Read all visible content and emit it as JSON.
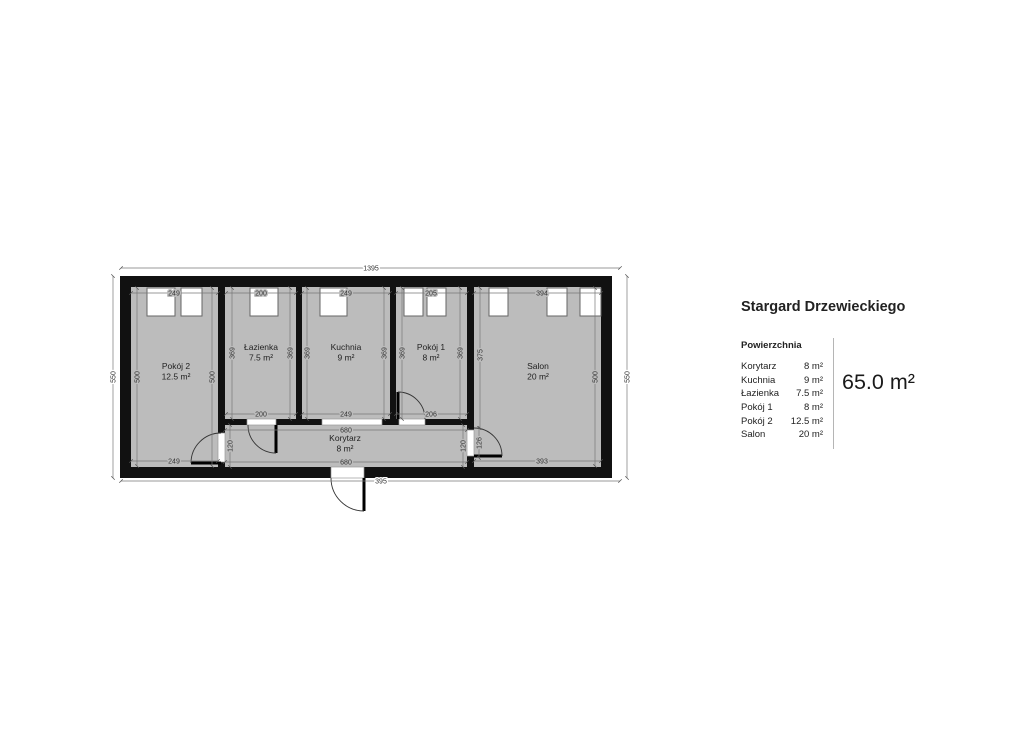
{
  "title": "Stargard Drzewieckiego",
  "panel": {
    "section_label": "Powierzchnia",
    "rows": [
      {
        "name": "Korytarz",
        "area": "8 m²"
      },
      {
        "name": "Kuchnia",
        "area": "9 m²"
      },
      {
        "name": "Łazienka",
        "area": "7.5 m²"
      },
      {
        "name": "Pokój 1",
        "area": "8 m²"
      },
      {
        "name": "Pokój 2",
        "area": "12.5 m²"
      },
      {
        "name": "Salon",
        "area": "20 m²"
      }
    ],
    "total_area": "65.0 m²"
  },
  "plan": {
    "rooms": {
      "pokoj2": {
        "name": "Pokój 2",
        "area": "12.5 m²"
      },
      "lazienka": {
        "name": "Łazienka",
        "area": "7.5 m²"
      },
      "kuchnia": {
        "name": "Kuchnia",
        "area": "9 m²"
      },
      "pokoj1": {
        "name": "Pokój 1",
        "area": "8 m²"
      },
      "salon": {
        "name": "Salon",
        "area": "20 m²"
      },
      "korytarz": {
        "name": "Korytarz",
        "area": "8 m²"
      }
    },
    "dims": {
      "total_width_top": "1395",
      "total_width_bottom": "395",
      "outer_height_left": "550",
      "outer_height_right": "550",
      "pokoj2_top": "249",
      "pokoj2_left": "500",
      "pokoj2_right": "500",
      "pokoj2_bottom": "249",
      "lazienka_top": "200",
      "lazienka_left": "369",
      "lazienka_right": "369",
      "lazienka_bottom": "200",
      "kuchnia_top": "249",
      "kuchnia_left": "369",
      "kuchnia_right": "369",
      "kuchnia_bottom": "249",
      "pokoj1_top": "205",
      "pokoj1_left": "369",
      "pokoj1_right": "369",
      "pokoj1_bottom": "206",
      "salon_top": "394",
      "salon_left": "375",
      "salon_right": "500",
      "salon_bottom": "393",
      "korytarz_top": "680",
      "korytarz_bottom": "680",
      "korytarz_left": "120",
      "korytarz_right": "120",
      "salon_door": "126"
    },
    "colors": {
      "wall": "#111111",
      "floor": "#bcbcbc",
      "dim_line": "#777777"
    }
  }
}
